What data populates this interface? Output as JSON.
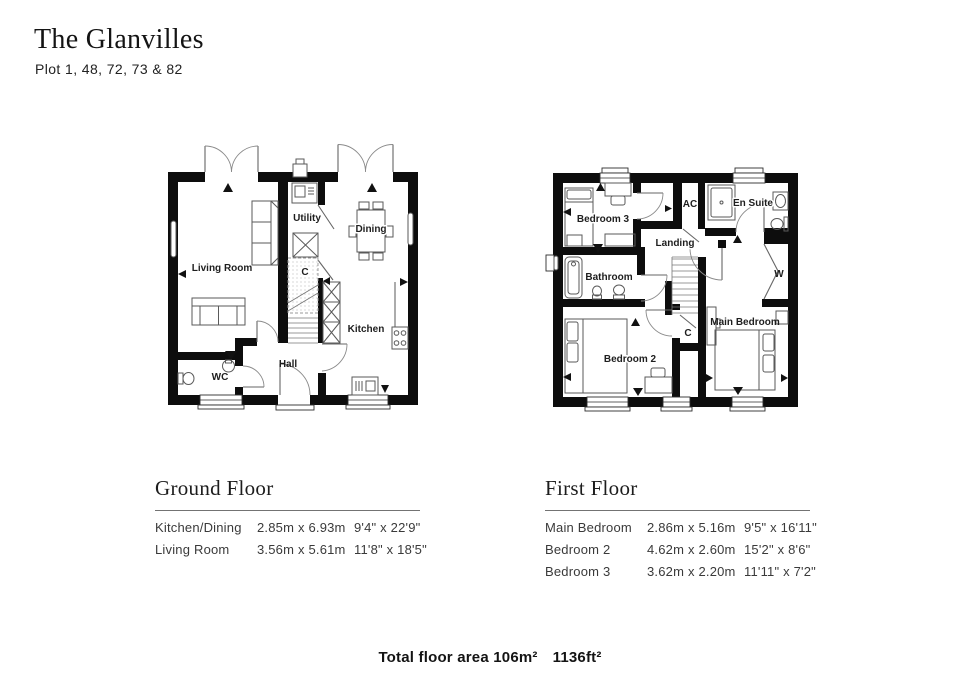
{
  "header": {
    "title": "The Glanvilles",
    "subtitle": "Plot 1, 48, 72, 73 & 82"
  },
  "ground_floor": {
    "heading": "Ground Floor",
    "rooms": {
      "living_room": "Living Room",
      "utility": "Utility",
      "dining": "Dining",
      "cupboard": "C",
      "kitchen": "Kitchen",
      "hall": "Hall",
      "wc": "WC"
    },
    "dimensions": [
      {
        "room": "Kitchen/Dining",
        "metric": "2.85m x 6.93m",
        "imperial": "9'4\" x 22'9\""
      },
      {
        "room": "Living Room",
        "metric": "3.56m x 5.61m",
        "imperial": "11'8\" x 18'5\""
      }
    ]
  },
  "first_floor": {
    "heading": "First Floor",
    "rooms": {
      "bedroom_3": "Bedroom 3",
      "ac": "AC",
      "en_suite": "En Suite",
      "landing": "Landing",
      "bathroom": "Bathroom",
      "wardrobe": "W",
      "cupboard": "C",
      "bedroom_2": "Bedroom 2",
      "main_bedroom": "Main Bedroom"
    },
    "dimensions": [
      {
        "room": "Main Bedroom",
        "metric": "2.86m x 5.16m",
        "imperial": "9'5\" x 16'11\""
      },
      {
        "room": "Bedroom 2",
        "metric": "4.62m x 2.60m",
        "imperial": "15'2\" x 8'6\""
      },
      {
        "room": "Bedroom 3",
        "metric": "3.62m x 2.20m",
        "imperial": "11'11\" x 7'2\""
      }
    ]
  },
  "footer": {
    "total_metric": "Total floor area 106m²",
    "total_imperial": "1136ft²"
  }
}
